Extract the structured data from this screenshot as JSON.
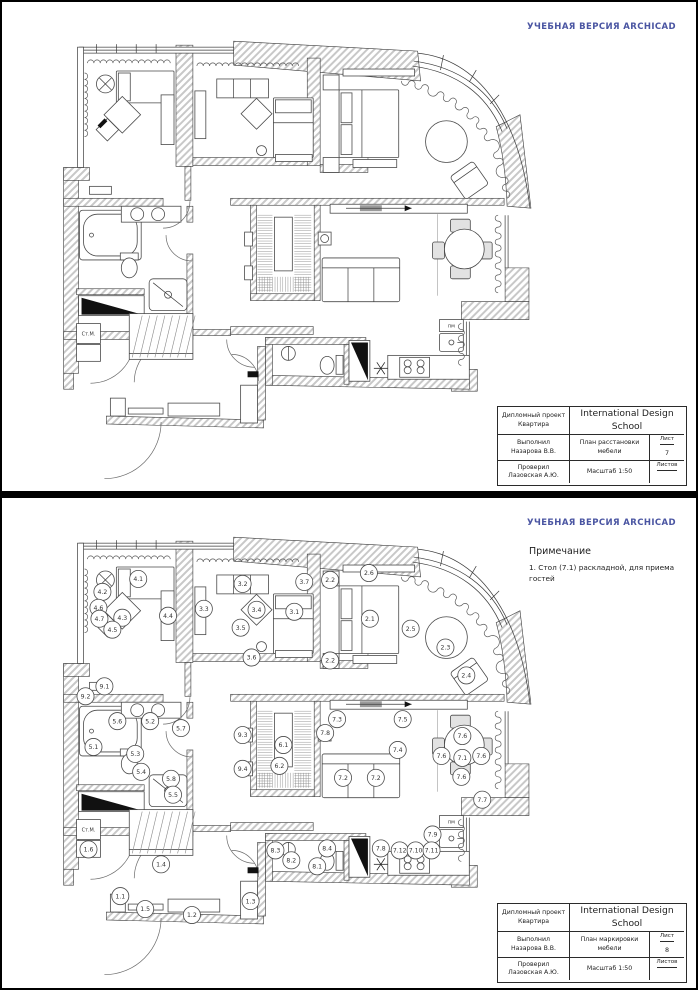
{
  "page1": {
    "watermark": "УЧЕБНАЯ ВЕРСИЯ ARCHICAD",
    "titleblock": {
      "project_label": "Дипломный проект",
      "project_name": "Квартира",
      "school": "International Design School",
      "author_label": "Выполнил",
      "author": "Назарова В.В.",
      "drawing_title": "План расстановки мебели",
      "sheet_label": "Лист",
      "sheet_number": "7",
      "checker_label": "Проверил",
      "checker": "Лазовская А.Ю.",
      "scale": "Масштаб 1:50",
      "sheets_label": "Листов",
      "sheets_value": ""
    }
  },
  "page2": {
    "watermark": "УЧЕБНАЯ ВЕРСИЯ ARCHICAD",
    "note_title": "Примечание",
    "note_lines": [
      "1. Стол (7.1) раскладной, для приема",
      "гостей"
    ],
    "titleblock": {
      "project_label": "Дипломный проект",
      "project_name": "Квартира",
      "school": "International Design School",
      "author_label": "Выполнил",
      "author": "Назарова В.В.",
      "drawing_title": "План маркировки мебели",
      "sheet_label": "Лист",
      "sheet_number": "8",
      "checker_label": "Проверил",
      "checker": "Лазовская А.Ю.",
      "scale": "Масштаб 1:50",
      "sheets_label": "Листов",
      "sheets_value": ""
    },
    "markers": [
      {
        "label": "4.1",
        "x": 137,
        "y": 80
      },
      {
        "label": "4.2",
        "x": 101,
        "y": 93
      },
      {
        "label": "4.6",
        "x": 97,
        "y": 109
      },
      {
        "label": "4.7",
        "x": 98,
        "y": 120
      },
      {
        "label": "4.3",
        "x": 121,
        "y": 119
      },
      {
        "label": "4.5",
        "x": 111,
        "y": 131
      },
      {
        "label": "4.4",
        "x": 167,
        "y": 117
      },
      {
        "label": "9.1",
        "x": 103,
        "y": 188
      },
      {
        "label": "9.2",
        "x": 84,
        "y": 198
      },
      {
        "label": "3.3",
        "x": 203,
        "y": 110
      },
      {
        "label": "3.2",
        "x": 242,
        "y": 85
      },
      {
        "label": "3.7",
        "x": 304,
        "y": 83
      },
      {
        "label": "3.4",
        "x": 256,
        "y": 111
      },
      {
        "label": "3.1",
        "x": 294,
        "y": 113
      },
      {
        "label": "3.5",
        "x": 240,
        "y": 129
      },
      {
        "label": "3.6",
        "x": 251,
        "y": 159
      },
      {
        "label": "2.2",
        "x": 330,
        "y": 81
      },
      {
        "label": "2.6",
        "x": 369,
        "y": 74
      },
      {
        "label": "2.1",
        "x": 370,
        "y": 120
      },
      {
        "label": "2.5",
        "x": 411,
        "y": 130
      },
      {
        "label": "2.3",
        "x": 446,
        "y": 149
      },
      {
        "label": "2.2",
        "x": 330,
        "y": 162
      },
      {
        "label": "2.4",
        "x": 467,
        "y": 177
      },
      {
        "label": "5.6",
        "x": 116,
        "y": 223
      },
      {
        "label": "5.2",
        "x": 149,
        "y": 223
      },
      {
        "label": "5.7",
        "x": 180,
        "y": 230
      },
      {
        "label": "5.1",
        "x": 92,
        "y": 249
      },
      {
        "label": "5.3",
        "x": 134,
        "y": 256
      },
      {
        "label": "5.4",
        "x": 140,
        "y": 274
      },
      {
        "label": "5.8",
        "x": 170,
        "y": 281
      },
      {
        "label": "5.5",
        "x": 172,
        "y": 297
      },
      {
        "label": "9.3",
        "x": 242,
        "y": 237
      },
      {
        "label": "9.4",
        "x": 242,
        "y": 271
      },
      {
        "label": "6.1",
        "x": 283,
        "y": 247
      },
      {
        "label": "6.2",
        "x": 279,
        "y": 268
      },
      {
        "label": "7.3",
        "x": 337,
        "y": 221
      },
      {
        "label": "7.5",
        "x": 403,
        "y": 221
      },
      {
        "label": "7.8",
        "x": 325,
        "y": 235
      },
      {
        "label": "7.4",
        "x": 398,
        "y": 252
      },
      {
        "label": "7.2",
        "x": 343,
        "y": 280
      },
      {
        "label": "7.2",
        "x": 376,
        "y": 280
      },
      {
        "label": "7.6",
        "x": 463,
        "y": 238
      },
      {
        "label": "7.6",
        "x": 442,
        "y": 258
      },
      {
        "label": "7.1",
        "x": 463,
        "y": 260
      },
      {
        "label": "7.6",
        "x": 482,
        "y": 258
      },
      {
        "label": "7.6",
        "x": 462,
        "y": 279
      },
      {
        "label": "7.7",
        "x": 483,
        "y": 302
      },
      {
        "label": "7.9",
        "x": 433,
        "y": 337
      },
      {
        "label": "7.8",
        "x": 381,
        "y": 351
      },
      {
        "label": "7.12",
        "x": 400,
        "y": 353
      },
      {
        "label": "7.10",
        "x": 416,
        "y": 353
      },
      {
        "label": "7.11",
        "x": 432,
        "y": 353
      },
      {
        "label": "8.3",
        "x": 275,
        "y": 353
      },
      {
        "label": "8.4",
        "x": 327,
        "y": 351
      },
      {
        "label": "8.2",
        "x": 291,
        "y": 363
      },
      {
        "label": "8.1",
        "x": 317,
        "y": 369
      },
      {
        "label": "1.6",
        "x": 87,
        "y": 352
      },
      {
        "label": "1.4",
        "x": 160,
        "y": 367
      },
      {
        "label": "1.1",
        "x": 119,
        "y": 399
      },
      {
        "label": "1.5",
        "x": 144,
        "y": 412
      },
      {
        "label": "1.2",
        "x": 191,
        "y": 418
      },
      {
        "label": "1.3",
        "x": 250,
        "y": 404
      }
    ]
  },
  "plan_labels": {
    "stm": "Ст.М.",
    "pm": "пм"
  },
  "colors": {
    "watermark_blue": "#4a55a2",
    "wall_hatch": "#c8c8c8"
  }
}
